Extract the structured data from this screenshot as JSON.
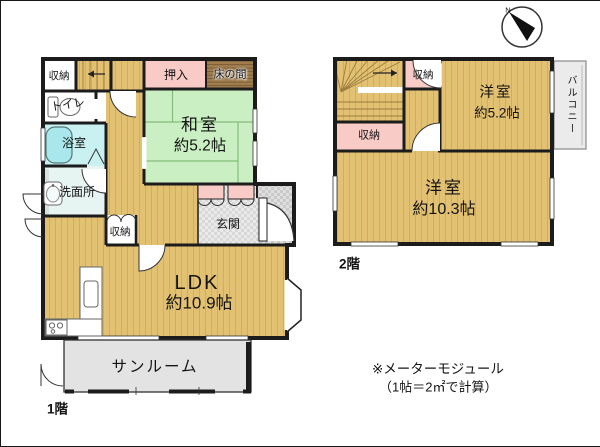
{
  "f1": {
    "floor_label": "1階",
    "storage_tl": "収納",
    "oshiire": "押入",
    "tokonoma": "床の間",
    "washitsu": "和室",
    "washitsu_size": "約5.2帖",
    "toilet": "トイレ",
    "bath": "浴室",
    "washroom": "洗面所",
    "storage_hall": "収納",
    "genkan": "玄関",
    "ldk": "LDK",
    "ldk_size": "約10.9帖",
    "sunroom": "サンルーム"
  },
  "f2": {
    "floor_label": "2階",
    "storage_a": "収納",
    "storage_b": "収納",
    "room_small": "洋室",
    "room_small_size": "約5.2帖",
    "room_large": "洋室",
    "room_large_size": "約10.3帖",
    "balcony": "バルコニー"
  },
  "note": {
    "line1": "※メーターモジュール",
    "line2": "（1帖＝2㎡で計算）"
  },
  "compass": {
    "north": "N"
  },
  "colors": {
    "wall": "#1c1c1c",
    "wood": "#e3c172",
    "wood-line": "#c49a43",
    "tatami": "#c9efc2",
    "tatami-line": "#84bd7d",
    "pink": "#f8cbc7",
    "bath": "#c9f1f2",
    "tub": "#a9e7ec",
    "washroom": "#e7f5f2",
    "tokonoma": "#a17c4c",
    "tokonoma-line": "#6d5231",
    "gray-room": "#e3e3e3",
    "balcony": "#ebebeb",
    "checker-a": "#eaeaea",
    "checker-b": "#d8d8d8",
    "checker-c": "#dfdfdf",
    "checker-d": "#c9c9c9"
  }
}
